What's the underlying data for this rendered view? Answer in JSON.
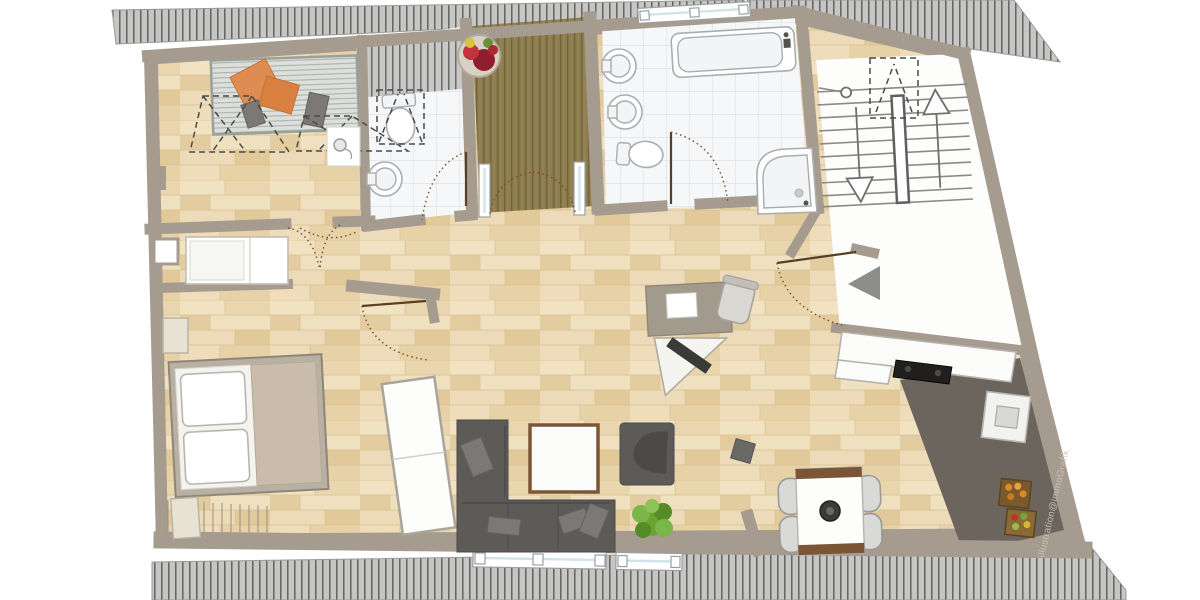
{
  "watermark": {
    "text": "illustration@immoGrafik"
  },
  "colors": {
    "wall": "#a59b8e",
    "wall_dark": "#8f8578",
    "wood_floor": "#ecd9b4",
    "tile_floor": "#f5f7f8",
    "tile_grout": "#dfe4e7",
    "deck_wood": "#8d7d4e",
    "deck_line": "#6e6038",
    "kitchen_floor": "#6b655d",
    "roof_band": "#c6c6c4",
    "roof_tick": "#55534f",
    "sofa": "#5d5b58",
    "accent_orange": "#de8c52",
    "plant_green": "#69a334",
    "door_arc": "#7a4a28",
    "window_glass": "#cfe3ea",
    "white_floor": "#fdfdfc",
    "furniture_white": "#fbfbfa",
    "bed_blanket": "#c9bcab",
    "table_wood": "#7a5636"
  }
}
